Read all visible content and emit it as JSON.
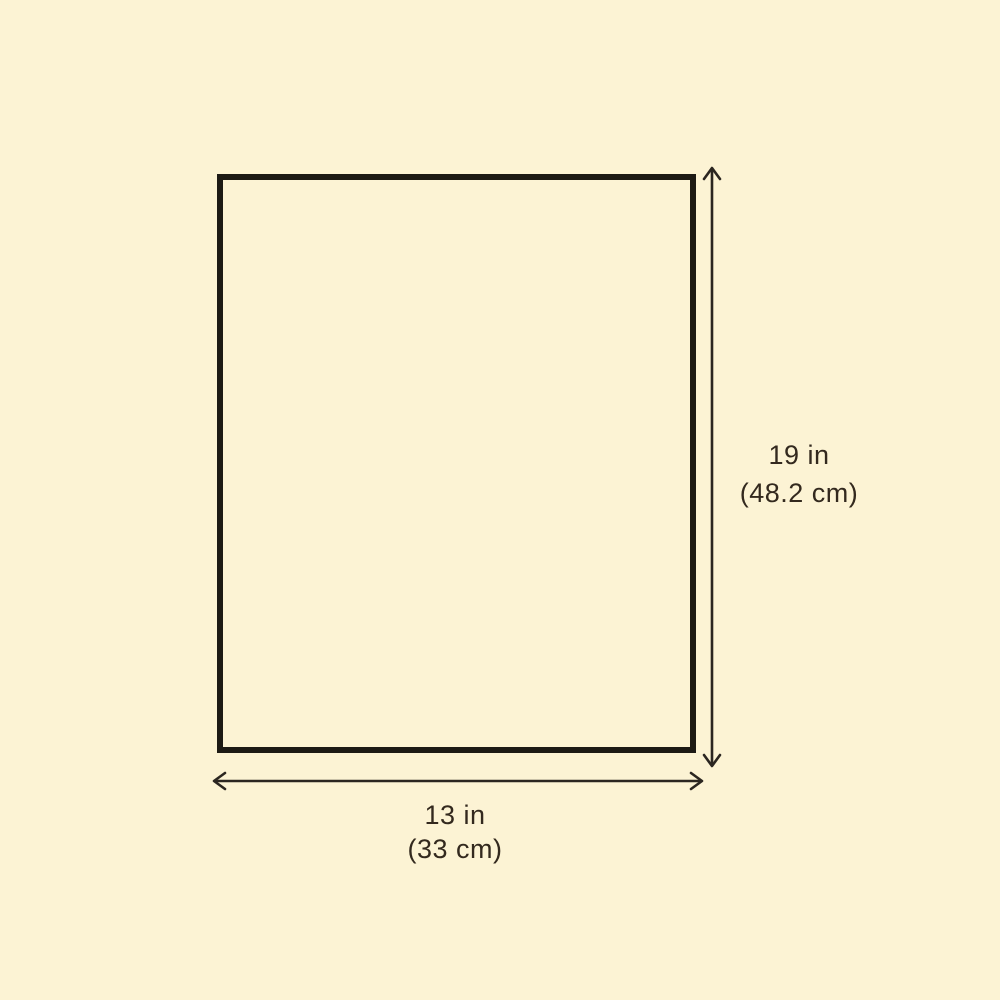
{
  "diagram": {
    "title": "product-dimension-diagram",
    "shape": "rectangle",
    "height_label": {
      "line1": "19 in",
      "line2": "(48.2 cm)"
    },
    "width_label": {
      "line1": "13 in",
      "line2": "(33 cm)"
    }
  },
  "colors": {
    "background": "#FCF3D4",
    "outline": "#1D1A14",
    "arrow": "#2B2620",
    "text": "#33291E"
  }
}
